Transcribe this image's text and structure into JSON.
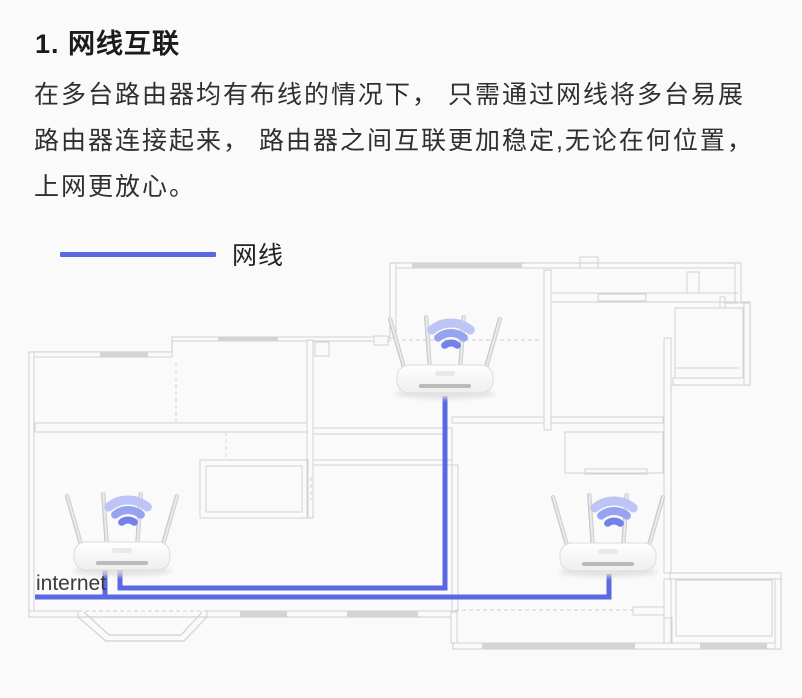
{
  "title": "1. 网线互联",
  "paragraph": {
    "lines": [
      "在多台路由器均有布线的情况下， 只需通过网线将多台易展",
      "路由器连接起来， 路由器之间互联更加稳定,无论在何位置，",
      "上网更放心。"
    ]
  },
  "legend": {
    "label": "网线",
    "color": "#5a68e1"
  },
  "floorplan": {
    "bg": "#fafafa",
    "wall_color": "#d2d2d2",
    "window_color": "#d4d4d4",
    "dashed_color": "#d8d8d8",
    "cable_color": "#5a68e1",
    "internet_label": "internet",
    "internet_label_pos": [
      36,
      590
    ],
    "boundary": "M 29 352 H 172 V 338 H 390 V 263 H 740 V 302 H 750 V 385 H 670 V 573 H 781 V 649 H 453 V 617 H 29 Z",
    "wall_boxes": [
      [
        29,
        352,
        143,
        5
      ],
      [
        172,
        337,
        218,
        4
      ],
      [
        390,
        263,
        350,
        5
      ],
      [
        29,
        352,
        5,
        260
      ],
      [
        29,
        611,
        49,
        6
      ],
      [
        207,
        611,
        246,
        6
      ],
      [
        453,
        643,
        328,
        6
      ],
      [
        775,
        573,
        6,
        76
      ],
      [
        664,
        338,
        7,
        235
      ],
      [
        633,
        607,
        31,
        8
      ],
      [
        390,
        263,
        6,
        75
      ],
      [
        35,
        423,
        273,
        9
      ],
      [
        307,
        340,
        6,
        178
      ],
      [
        313,
        428,
        139,
        6
      ],
      [
        445,
        428,
        7,
        37
      ],
      [
        452,
        417,
        211,
        6
      ],
      [
        544,
        270,
        7,
        160
      ],
      [
        670,
        573,
        111,
        6
      ],
      [
        664,
        579,
        7,
        64
      ],
      [
        673,
        378,
        77,
        7
      ],
      [
        744,
        303,
        6,
        82
      ],
      [
        725,
        303,
        19,
        5
      ],
      [
        720,
        297,
        5,
        11
      ],
      [
        735,
        263,
        6,
        40
      ],
      [
        452,
        465,
        6,
        146
      ],
      [
        313,
        460,
        139,
        5
      ],
      [
        451,
        612,
        6,
        31
      ],
      [
        374,
        336,
        14,
        9
      ]
    ],
    "windows": [
      [
        100,
        352,
        48,
        5
      ],
      [
        218,
        337,
        60,
        4
      ],
      [
        412,
        263,
        110,
        5
      ],
      [
        240,
        611,
        47,
        6
      ],
      [
        347,
        611,
        71,
        6
      ],
      [
        482,
        643,
        153,
        6
      ],
      [
        700,
        643,
        67,
        6
      ]
    ],
    "lines": [
      [
        552,
        293,
        738,
        293
      ],
      [
        552,
        302,
        738,
        302
      ],
      [
        675,
        368,
        739,
        368
      ]
    ],
    "dashed_lines": [
      [
        176,
        363,
        176,
        423
      ],
      [
        226,
        432,
        226,
        460
      ],
      [
        395,
        340,
        540,
        340
      ],
      [
        455,
        610,
        633,
        610
      ],
      [
        78,
        611,
        207,
        611
      ],
      [
        78,
        617,
        207,
        617
      ],
      [
        311,
        477,
        311,
        500
      ]
    ],
    "outline_rects": [
      [
        687,
        272,
        12,
        21
      ],
      [
        598,
        294,
        48,
        7
      ],
      [
        315,
        342,
        14,
        14
      ],
      [
        580,
        257,
        18,
        11
      ],
      [
        200,
        460,
        108,
        58
      ],
      [
        206,
        466,
        96,
        46
      ],
      [
        676,
        580,
        96,
        56
      ],
      [
        675,
        308,
        68,
        70
      ],
      [
        565,
        432,
        98,
        41
      ],
      [
        585,
        469,
        62,
        5
      ],
      [
        664,
        618,
        8,
        25
      ]
    ],
    "bay_polylines": [
      "78,617 106,641 184,641 207,617",
      "84,612 109,635 181,635 202,612"
    ],
    "cables": [
      {
        "name": "cable-top-router",
        "d": "M 445 396 L 445 588 L 120 588 L 120 563"
      },
      {
        "name": "cable-internet-feed",
        "d": "M 35 597 L 609 597 L 609 574"
      },
      {
        "name": "cable-internet-router",
        "d": "M 105 597 L 105 563"
      }
    ],
    "routers": [
      {
        "name": "router-top",
        "cx": 445,
        "cy": 379
      },
      {
        "name": "router-internet",
        "cx": 122,
        "cy": 556
      },
      {
        "name": "router-right",
        "cx": 608,
        "cy": 557
      }
    ],
    "wifi_colors": [
      "#bcc5f6",
      "#96a3f1",
      "#7282ea"
    ]
  }
}
